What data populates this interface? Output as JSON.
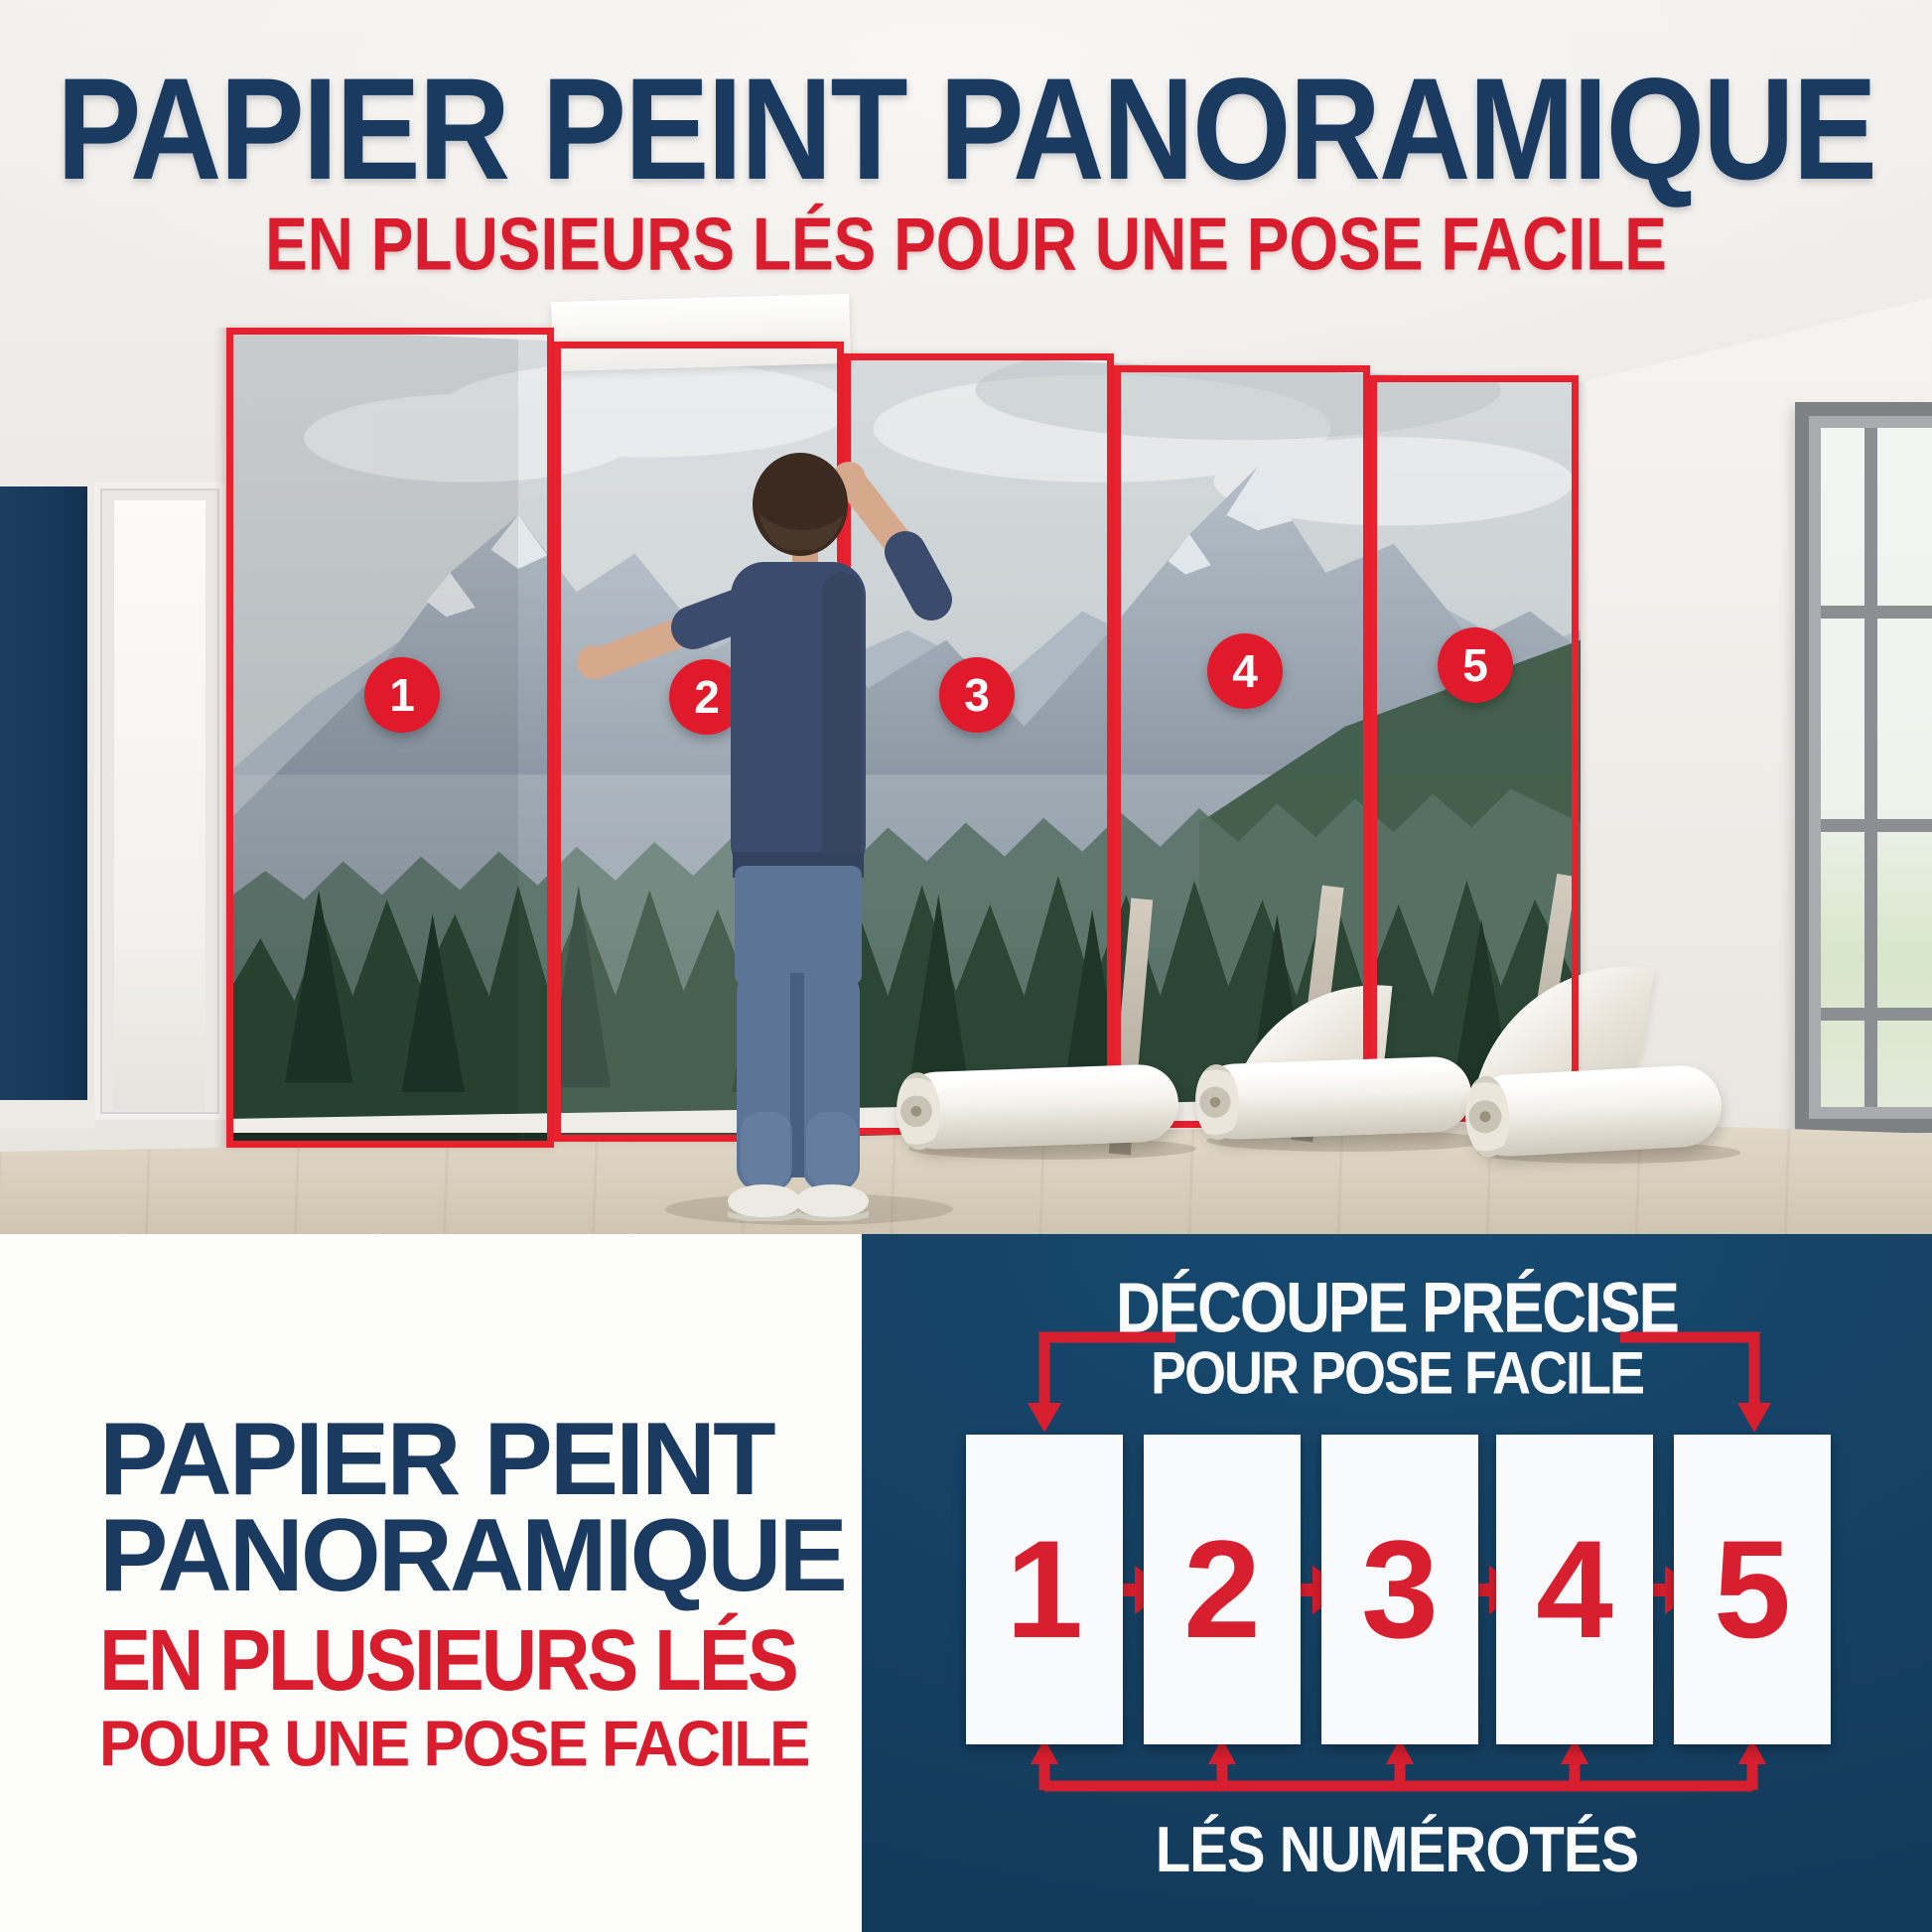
{
  "palette": {
    "navy_text": "#1a3a60",
    "red": "#d81e2e",
    "outline_red": "#e8212f",
    "diagram_bg": "#164569",
    "accent_wall": "#16385a",
    "white": "#ffffff"
  },
  "header": {
    "title": "PAPIER PEINT PANORAMIQUE",
    "subtitle": "EN PLUSIEURS LÉS POUR UNE POSE FACILE"
  },
  "photo": {
    "strip_numbers": [
      "1",
      "2",
      "3",
      "4",
      "5"
    ]
  },
  "bottom_left": {
    "title_line1": "PAPIER PEINT",
    "title_line2": "PANORAMIQUE",
    "subtitle_line1": "EN PLUSIEURS LÉS",
    "subtitle_line2": "POUR UNE POSE FACILE"
  },
  "diagram": {
    "title_line1": "DÉCOUPE PRÉCISE",
    "title_line2": "POUR POSE FACILE",
    "strip_numbers": [
      "1",
      "2",
      "3",
      "4",
      "5"
    ],
    "caption": "LÉS NUMÉROTÉS"
  }
}
